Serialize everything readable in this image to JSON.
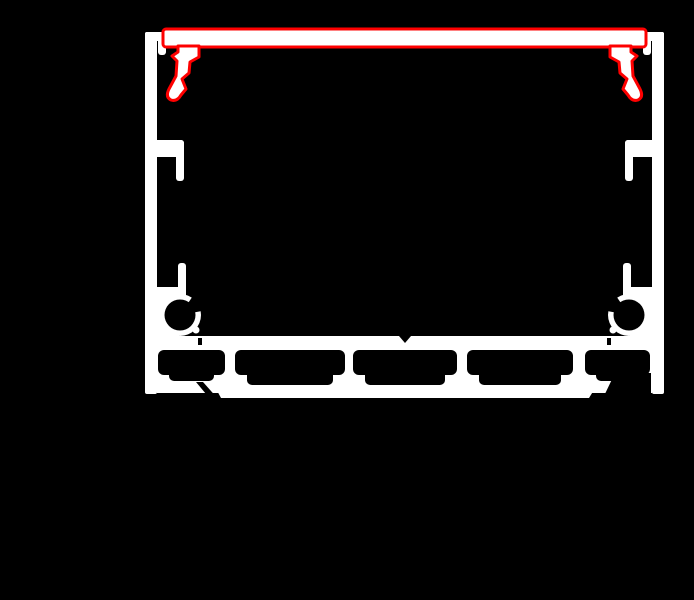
{
  "canvas": {
    "width": 694,
    "height": 600
  },
  "colors": {
    "background": "#000000",
    "profile_white": "#ffffff",
    "cover_red": "#fe0000"
  },
  "diagram": {
    "type": "technical-cross-section",
    "parts": [
      {
        "name": "profile-body",
        "color": "#ffffff"
      },
      {
        "name": "left-side-wall",
        "color": "#ffffff"
      },
      {
        "name": "right-side-wall",
        "color": "#ffffff"
      },
      {
        "name": "mounting-grooves",
        "color": "#ffffff"
      },
      {
        "name": "screw-ports",
        "color": "#ffffff"
      },
      {
        "name": "led-platform",
        "color": "#ffffff"
      },
      {
        "name": "hollow-chambers",
        "color": "#000000"
      },
      {
        "name": "diffuser-cover",
        "color": "#fe0000"
      }
    ]
  }
}
